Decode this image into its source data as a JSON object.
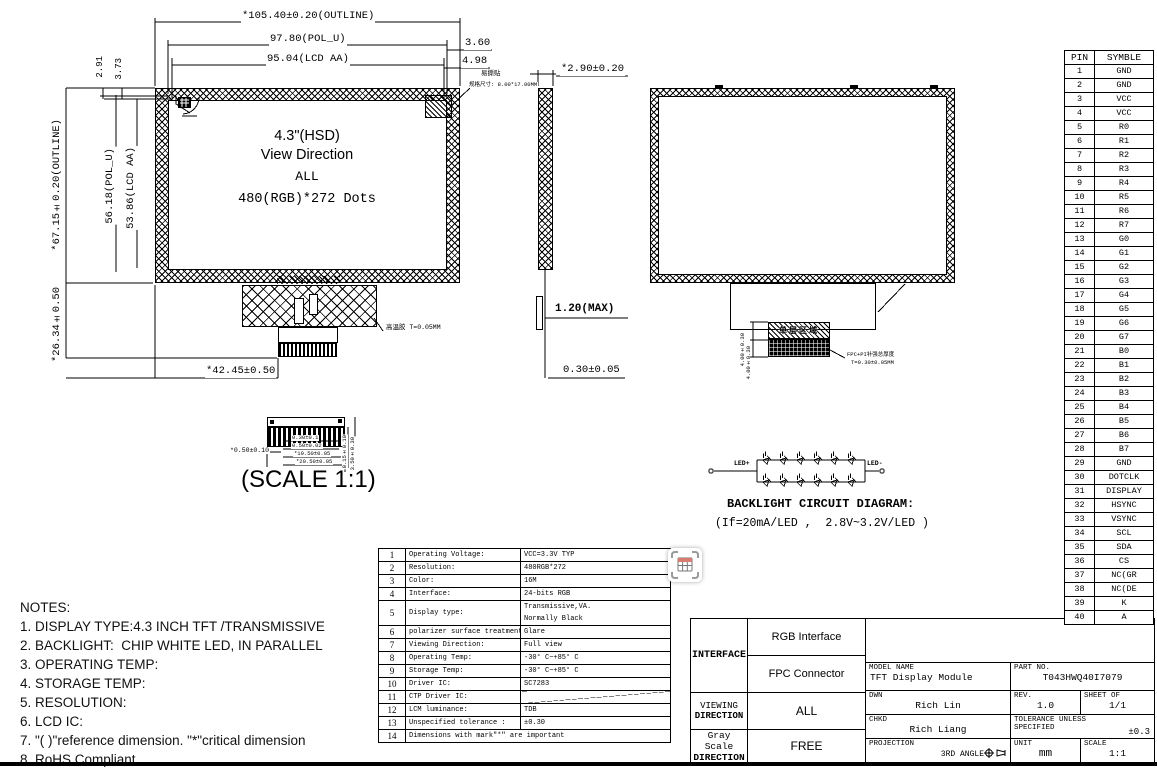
{
  "front_view": {
    "center_lines": {
      "l1": "4.3\"(HSD)",
      "l2": "View Direction",
      "l3": "ALL",
      "l4": "480(RGB)*272 Dots"
    },
    "dims": {
      "outline_w": "*105.40±0.20(OUTLINE)",
      "pol_w": "97.80(POL_U)",
      "lcd_w": "95.04(LCD AA)",
      "d_3_60": "3.60",
      "d_4_98": "4.98",
      "outline_h": "*67.15±0.20(OUTLINE)",
      "pol_h": "56.18(POL_U)",
      "lcd_h": "53.86(LCD AA)",
      "d_2_91": "2.91",
      "d_3_73": "3.73",
      "d_26_34": "*26.34±0.50",
      "d_42_45": "*42.45±0.50"
    },
    "labels": {
      "sticker_name": "易撕贴",
      "sticker_size": "规格尺寸: 8.00*17.00MM",
      "tape": "高温胶 T=0.05MM"
    }
  },
  "side_view": {
    "dims": {
      "d_2_90": "*2.90±0.20",
      "d_1_20": "1.20(MAX)",
      "d_0_30": "0.30±0.05"
    }
  },
  "back_view": {
    "strip_label": "单层区域",
    "fpc_note_1": "FPC+PI补强总厚度",
    "fpc_note_2": "T=0.30±0.05MM",
    "dim_a": "4.00±0.30",
    "dim_b": "4.00±0.30"
  },
  "connector_detail": {
    "scale_label": "(SCALE 1:1)",
    "dims": {
      "d1": "*0.50±0.10",
      "d2": "0.30±0.1",
      "d3": "0.50±0.02",
      "d4": "*19.50±0.05",
      "d5": "*20.50±0.05",
      "d6": "0.15±0.10",
      "d7": "3.50±0.30"
    }
  },
  "backlight": {
    "title": "BACKLIGHT CIRCUIT DIAGRAM:",
    "subtitle": "(If=20mA/LED ,  2.8V~3.2V/LED )",
    "led_plus": "LED+",
    "led_minus": "LED-",
    "rows": 2,
    "leds_per_row": 6
  },
  "notes": [
    "NOTES:",
    "1. DISPLAY TYPE:4.3 INCH TFT /TRANSMISSIVE",
    "2. BACKLIGHT:  CHIP WHITE LED, IN PARALLEL",
    "3. OPERATING TEMP:",
    "4. STORAGE TEMP:",
    "5. RESOLUTION:",
    "6. LCD IC:",
    "7. \"( )\"reference dimension. \"*\"critical dimension",
    "8. RoHS Compliant"
  ],
  "pin_table": {
    "headers": [
      "PIN",
      "SYMBLE"
    ],
    "rows": [
      [
        "1",
        "GND"
      ],
      [
        "2",
        "GND"
      ],
      [
        "3",
        "VCC"
      ],
      [
        "4",
        "VCC"
      ],
      [
        "5",
        "R0"
      ],
      [
        "6",
        "R1"
      ],
      [
        "7",
        "R2"
      ],
      [
        "8",
        "R3"
      ],
      [
        "9",
        "R4"
      ],
      [
        "10",
        "R5"
      ],
      [
        "11",
        "R6"
      ],
      [
        "12",
        "R7"
      ],
      [
        "13",
        "G0"
      ],
      [
        "14",
        "G1"
      ],
      [
        "15",
        "G2"
      ],
      [
        "16",
        "G3"
      ],
      [
        "17",
        "G4"
      ],
      [
        "18",
        "G5"
      ],
      [
        "19",
        "G6"
      ],
      [
        "20",
        "G7"
      ],
      [
        "21",
        "B0"
      ],
      [
        "22",
        "B1"
      ],
      [
        "23",
        "B2"
      ],
      [
        "24",
        "B3"
      ],
      [
        "25",
        "B4"
      ],
      [
        "26",
        "B5"
      ],
      [
        "27",
        "B6"
      ],
      [
        "28",
        "B7"
      ],
      [
        "29",
        "GND"
      ],
      [
        "30",
        "DOTCLK"
      ],
      [
        "31",
        "DISPLAY"
      ],
      [
        "32",
        "HSYNC"
      ],
      [
        "33",
        "VSYNC"
      ],
      [
        "34",
        "SCL"
      ],
      [
        "35",
        "SDA"
      ],
      [
        "36",
        "CS"
      ],
      [
        "37",
        "NC(GR"
      ],
      [
        "38",
        "NC(DE"
      ],
      [
        "39",
        "K"
      ],
      [
        "40",
        "A"
      ]
    ]
  },
  "spec_table": {
    "rows": [
      {
        "no": "1",
        "name": "Operating Voltage:",
        "value": "VCC=3.3V TYP"
      },
      {
        "no": "2",
        "name": "Resolution:",
        "value": "480RGB*272"
      },
      {
        "no": "3",
        "name": "Color:",
        "value": "16M"
      },
      {
        "no": "4",
        "name": "Interface:",
        "value": "24-bits RGB"
      },
      {
        "no": "5",
        "name": "Display type:",
        "value": "Transmissive,VA.",
        "value2": "Normally Black"
      },
      {
        "no": "6",
        "name": "polarizer surface treatment:",
        "value": "Glare"
      },
      {
        "no": "7",
        "name": "Viewing Direction:",
        "value": "Full view"
      },
      {
        "no": "8",
        "name": "Operating Temp:",
        "value": "-30° C~+85° C"
      },
      {
        "no": "9",
        "name": "Storage Temp:",
        "value": "-30° C~+85° C"
      },
      {
        "no": "10",
        "name": "Driver IC:",
        "value": "SC7283"
      },
      {
        "no": "11",
        "name": "CTP Driver IC:",
        "value": "",
        "diagonal": true
      },
      {
        "no": "12",
        "name": "LCM luminance:",
        "value": "TDB"
      },
      {
        "no": "13",
        "name": "Unspecified tolerance :",
        "value": "±0.30"
      },
      {
        "no": "14",
        "name": "Dimensions with mark\"*\" are important",
        "span": true
      }
    ]
  },
  "title_block": {
    "interface_label": "INTERFACE",
    "interface_row1": "RGB Interface",
    "interface_row2": "FPC Connector",
    "viewing_label_1": "VIEWING",
    "viewing_label_2": "DIRECTION",
    "viewing_value": "ALL",
    "gray_label_1": "Gray Scale",
    "gray_label_2": "DIRECTION",
    "gray_value": "FREE",
    "model_name_label": "MODEL NAME",
    "model_name": "TFT Display Module",
    "part_no_label": "PART NO.",
    "part_no": "T043HWQ40I7079",
    "dwn_label": "DWN",
    "dwn": "Rich Lin",
    "rev_label": "REV.",
    "rev": "1.0",
    "sheet_label": "SHEET OF",
    "sheet": "1/1",
    "chkd_label": "CHKD",
    "chkd": "Rich Liang",
    "tolerance_label_1": "TOLERANCE UNLESS",
    "tolerance_label_2": "SPECIFIED",
    "tolerance": "±0.3",
    "projection_label": "PROJECTION",
    "projection_value": "3RD ANGLE",
    "unit_label": "UNIT",
    "unit": "mm",
    "scale_label": "SCALE",
    "scale": "1:1"
  }
}
